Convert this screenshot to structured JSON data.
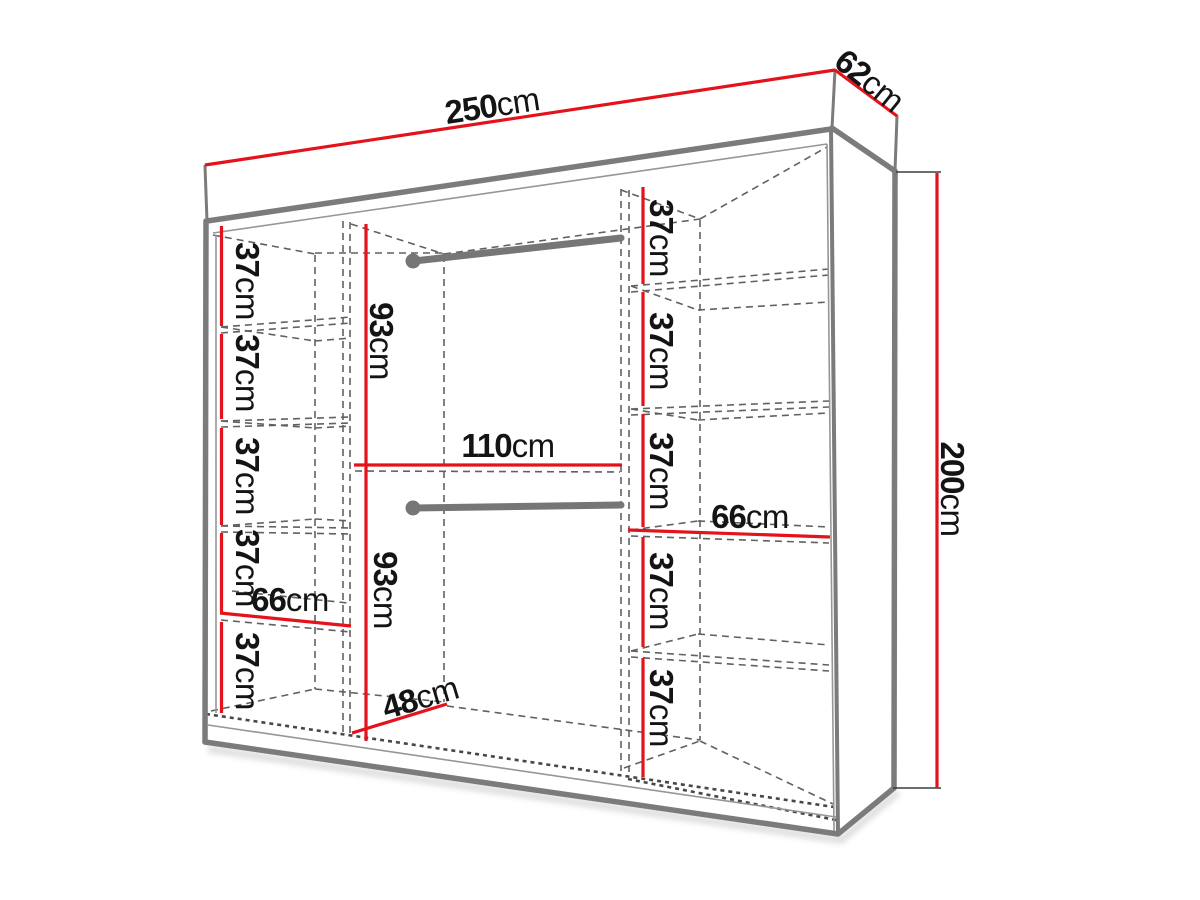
{
  "diagram": {
    "type": "wardrobe-dimension-diagram",
    "colors": {
      "dimension_red": "#e4131b",
      "outline_gray": "#7b7b7b",
      "hidden_line_gray": "#616161",
      "text_black": "#141414"
    },
    "labels": {
      "overall_width": {
        "value": "250",
        "unit": "cm"
      },
      "overall_depth": {
        "value": "62",
        "unit": "cm"
      },
      "overall_height": {
        "value": "200",
        "unit": "cm"
      },
      "center_width": {
        "value": "110",
        "unit": "cm"
      },
      "hanging_top": {
        "value": "93",
        "unit": "cm"
      },
      "hanging_bottom": {
        "value": "93",
        "unit": "cm"
      },
      "interior_depth": {
        "value": "48",
        "unit": "cm"
      },
      "left_shelf_width": {
        "value": "66",
        "unit": "cm"
      },
      "right_shelf_width": {
        "value": "66",
        "unit": "cm"
      },
      "left_shelves": [
        {
          "value": "37",
          "unit": "cm"
        },
        {
          "value": "37",
          "unit": "cm"
        },
        {
          "value": "37",
          "unit": "cm"
        },
        {
          "value": "37",
          "unit": "cm"
        },
        {
          "value": "37",
          "unit": "cm"
        }
      ],
      "right_shelves": [
        {
          "value": "37",
          "unit": "cm"
        },
        {
          "value": "37",
          "unit": "cm"
        },
        {
          "value": "37",
          "unit": "cm"
        },
        {
          "value": "37",
          "unit": "cm"
        },
        {
          "value": "37",
          "unit": "cm"
        }
      ]
    }
  }
}
